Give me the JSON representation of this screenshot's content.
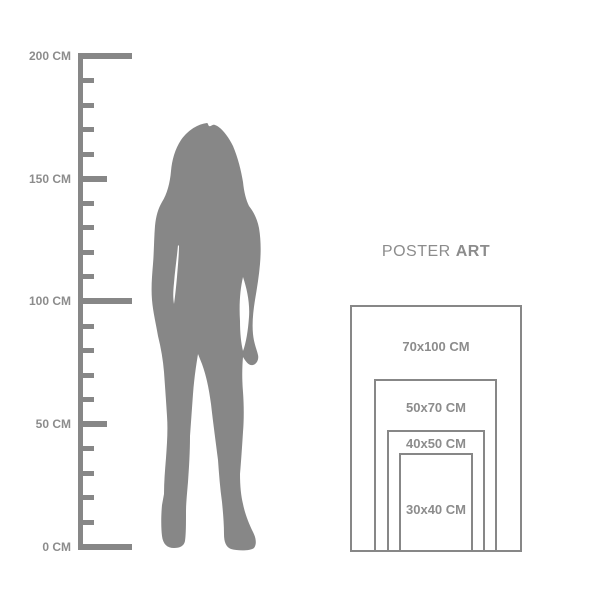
{
  "colors": {
    "background": "#ffffff",
    "gray_shapes": "#878787",
    "gray_text": "#8c8c8c"
  },
  "ruler": {
    "unit": "CM",
    "min_cm": 0,
    "max_cm": 200,
    "tick_interval_cm": 10,
    "labels": [
      {
        "cm": 200,
        "text": "200 CM"
      },
      {
        "cm": 150,
        "text": "150 CM"
      },
      {
        "cm": 100,
        "text": "100 CM"
      },
      {
        "cm": 50,
        "text": "50 CM"
      },
      {
        "cm": 0,
        "text": "0 CM"
      }
    ]
  },
  "figure": {
    "description": "gray silhouette of a standing woman with long hair, one hand in pocket, approx 175 cm tall"
  },
  "poster_guide": {
    "title_regular": "POSTER",
    "title_bold": "ART",
    "sizes": [
      {
        "label": "70x100 CM",
        "width_cm": 70,
        "height_cm": 100
      },
      {
        "label": "50x70 CM",
        "width_cm": 50,
        "height_cm": 70
      },
      {
        "label": "40x50 CM",
        "width_cm": 40,
        "height_cm": 50
      },
      {
        "label": "30x40 CM",
        "width_cm": 30,
        "height_cm": 40
      }
    ]
  }
}
